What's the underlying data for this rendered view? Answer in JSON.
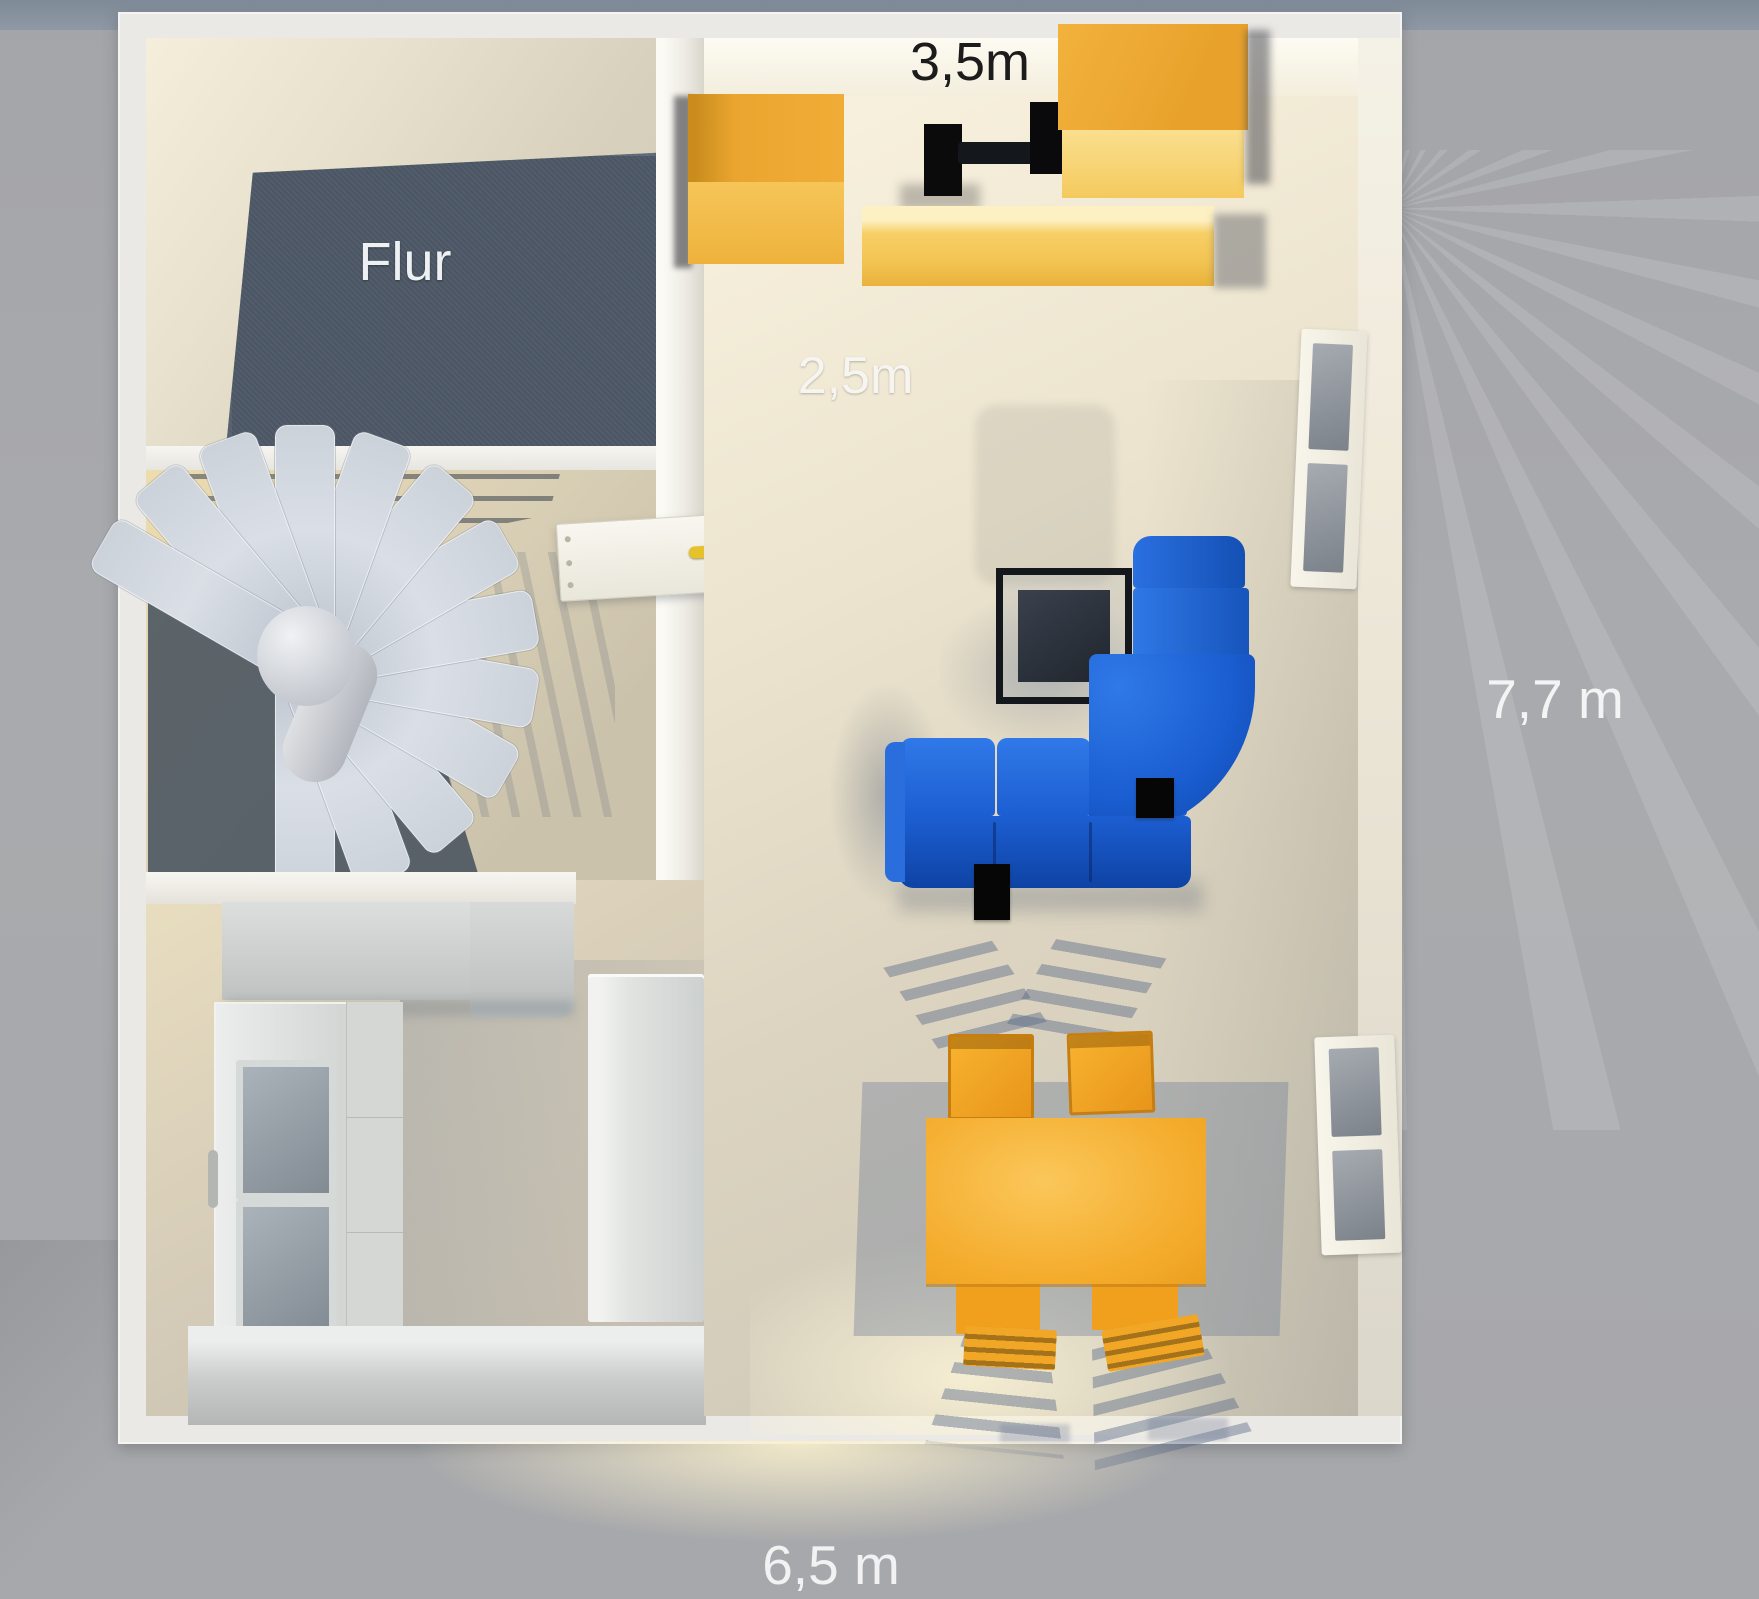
{
  "scene": {
    "type": "3d-floorplan-render",
    "background_color": "#a9aaad",
    "top_band_color": "#8f99a5"
  },
  "labels": {
    "room_flur": "Flur",
    "dim_top_width": "3,5m",
    "dim_hall_depth": "2,5m",
    "dim_right_height": "7,7 m",
    "dim_bottom_width": "6,5 m"
  },
  "rooms": {
    "hallway": "Flur",
    "stairwell": "spiral staircase room",
    "kitchen": "kitchen",
    "living": "living / dining room"
  },
  "objects": [
    "spiral-staircase",
    "room-door",
    "kitchen-counter",
    "glass-cabinet",
    "drawer-unit",
    "fridge",
    "base-counter",
    "wardrobe-left",
    "tv-setup",
    "wardrobe-right",
    "bench",
    "corner-sofa",
    "coffee-table",
    "dining-table",
    "dining-chair-1",
    "dining-chair-2",
    "dining-chair-3",
    "dining-chair-4",
    "window-upper",
    "window-lower",
    "speaker-1",
    "speaker-2"
  ],
  "colors": {
    "wall_white": "#ebe9e5",
    "flur_floor": "#4d5866",
    "living_floor_light": "#f9f2df",
    "living_floor_dark": "#ccc6b6",
    "sofa_blue": "#1c5ed2",
    "furniture_orange": "#f4ab2b",
    "furniture_yellow_light": "#f4ca5f",
    "stair_step_gray": "#ccd2da",
    "window_pane_gray": "#8b9199",
    "coffee_table_black": "#14171b",
    "label_white": "#f4f4f4",
    "label_black": "#1c1c1c"
  }
}
